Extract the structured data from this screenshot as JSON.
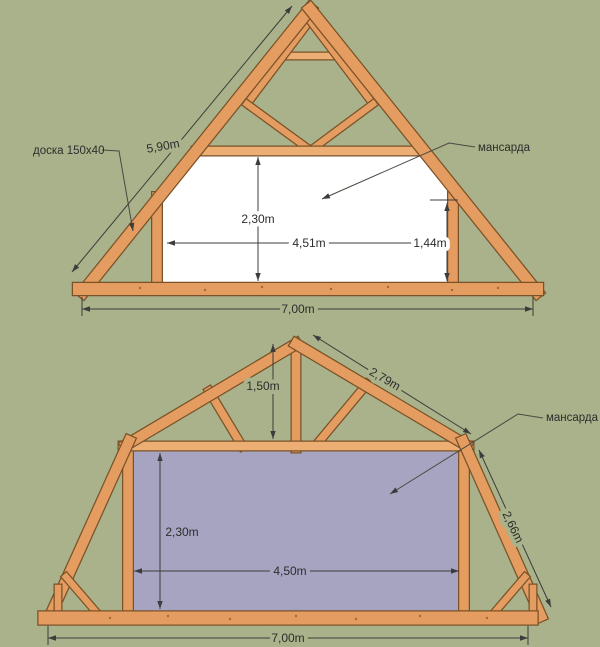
{
  "colors": {
    "background": "#a9b28a",
    "wood": "#e59c60",
    "wood_outline": "#7a5228",
    "attic_room_top": "#ffffff",
    "attic_room_bottom": "#a6a4c0",
    "dimension_line": "#3c3c3c"
  },
  "truss_top": {
    "labels": {
      "board": "доска 150x40",
      "mansard": "мансарда",
      "rafter_length": "5,90m",
      "room_height": "2,30m",
      "room_width": "4,51m",
      "wall_height": "1,44m",
      "span": "7,00m"
    }
  },
  "truss_bottom": {
    "labels": {
      "mansard": "мансарда",
      "ridge_height": "1,50m",
      "upper_rafter_length": "2,79m",
      "lower_rafter_length": "2,66m",
      "room_height": "2,30m",
      "room_width": "4,50m",
      "span": "7,00m"
    }
  }
}
